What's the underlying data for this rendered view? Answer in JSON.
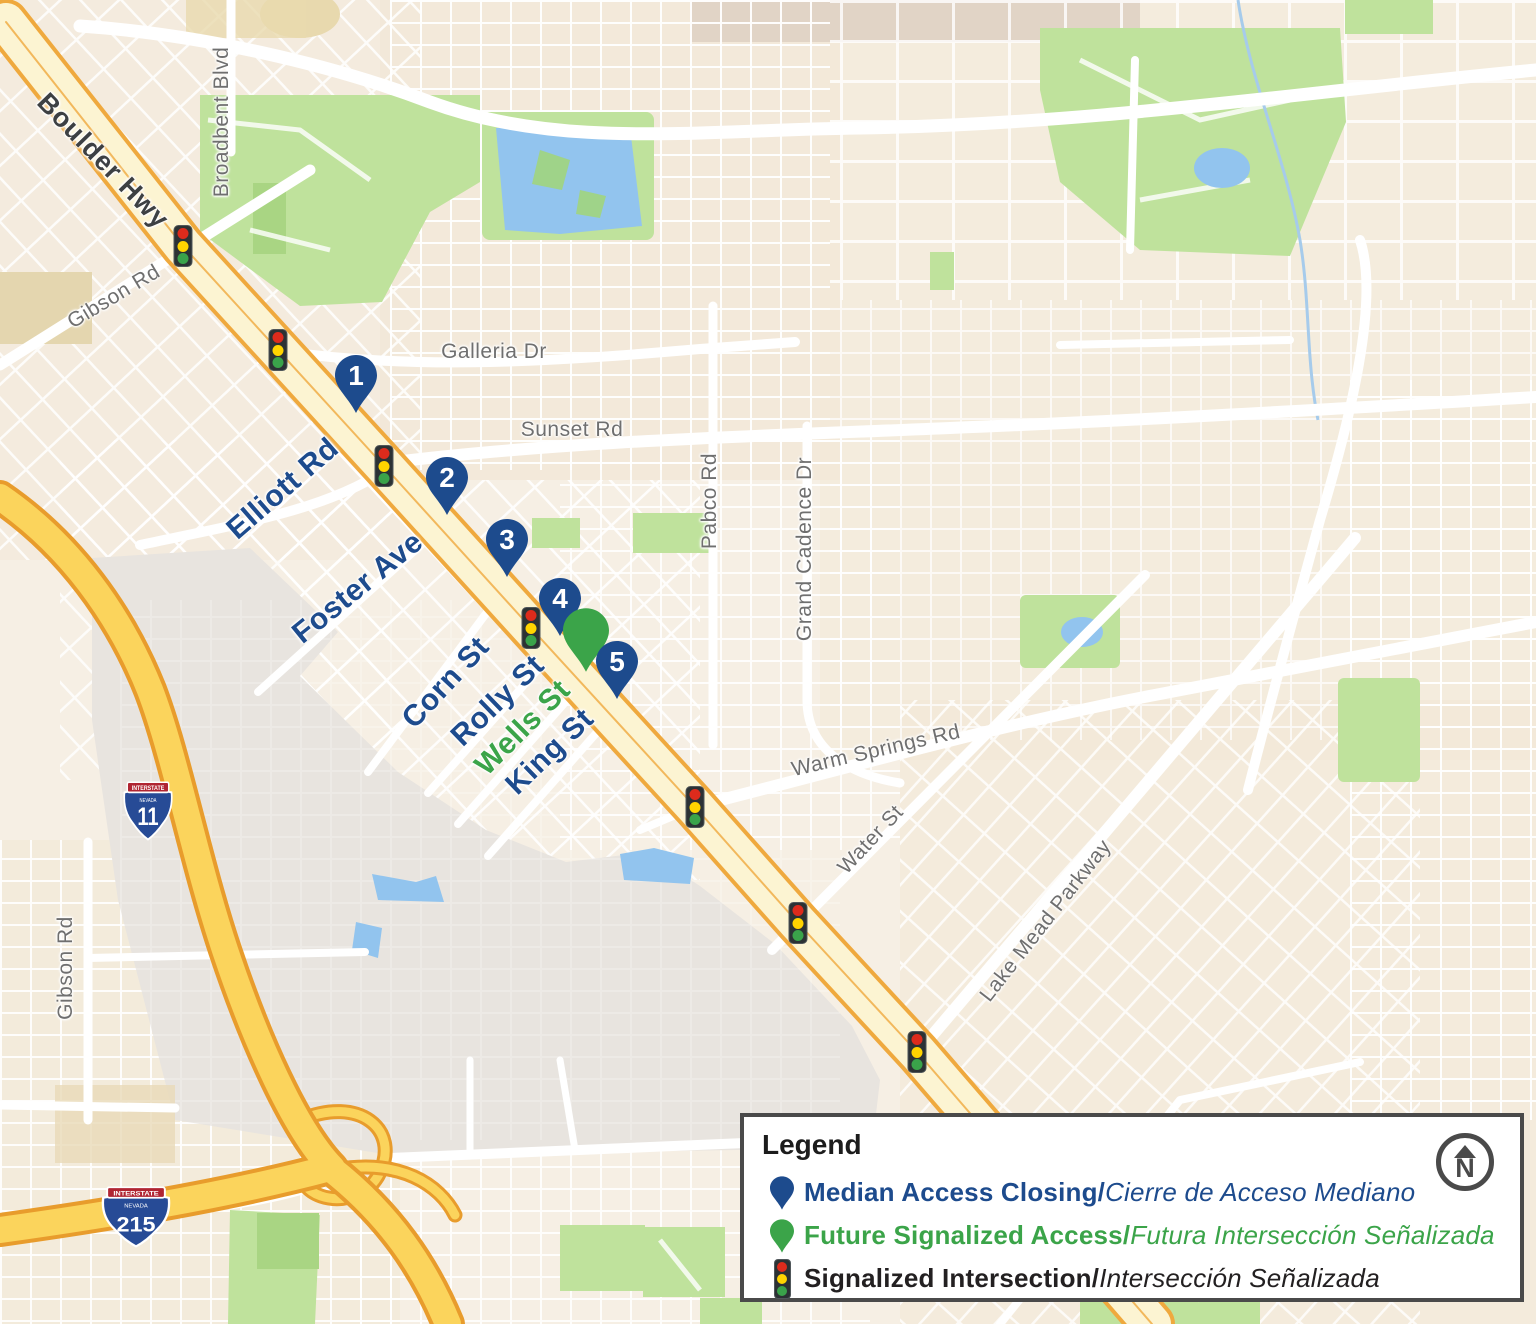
{
  "title": "Boulder Highway median access closing map",
  "colors": {
    "navy": "#1d4b8d",
    "green": "#3ba449",
    "boulder_hwy_fill": "#fcf4d2",
    "boulder_hwy_casing": "#efa93e",
    "freeway_fill": "#fbd45c",
    "freeway_casing": "#e89c2c",
    "park_green": "#bfe29c",
    "water_blue": "#92c4ee",
    "industrial_gray": "#e8e4df",
    "legend_border": "#4a4a4a",
    "traffic_red": "#dd2b1c",
    "traffic_yellow": "#ffd400",
    "traffic_green": "#3aa34a"
  },
  "map": {
    "street_labels": [
      {
        "text": "Boulder Hwy",
        "x": 103,
        "y": 161,
        "rot": 46,
        "style": "hwy"
      },
      {
        "text": "Broadbent Blvd",
        "x": 222,
        "y": 122,
        "rot": -90,
        "style": "gray"
      },
      {
        "text": "Gibson Rd",
        "x": 114,
        "y": 297,
        "rot": -31,
        "style": "gray"
      },
      {
        "text": "Galleria Dr",
        "x": 494,
        "y": 352,
        "rot": 0,
        "style": "gray"
      },
      {
        "text": "Sunset Rd",
        "x": 572,
        "y": 430,
        "rot": 0,
        "style": "gray"
      },
      {
        "text": "Pabco Rd",
        "x": 710,
        "y": 501,
        "rot": -90,
        "style": "gray"
      },
      {
        "text": "Grand Cadence Dr",
        "x": 805,
        "y": 549,
        "rot": -90,
        "style": "gray"
      },
      {
        "text": "Warm Springs Rd",
        "x": 876,
        "y": 751,
        "rot": -13,
        "style": "gray"
      },
      {
        "text": "Water St",
        "x": 871,
        "y": 840,
        "rot": -47,
        "style": "gray"
      },
      {
        "text": "Lake Mead Parkway",
        "x": 1046,
        "y": 921,
        "rot": -52,
        "style": "gray"
      },
      {
        "text": "Gibson Rd",
        "x": 66,
        "y": 968,
        "rot": -90,
        "style": "gray"
      },
      {
        "text": "Elliott Rd",
        "x": 283,
        "y": 489,
        "rot": -41,
        "style": "navy"
      },
      {
        "text": "Foster Ave",
        "x": 358,
        "y": 588,
        "rot": -39,
        "style": "navy"
      },
      {
        "text": "Corn St",
        "x": 446,
        "y": 683,
        "rot": -47,
        "style": "navy"
      },
      {
        "text": "Rolly St",
        "x": 498,
        "y": 701,
        "rot": -44,
        "style": "navy"
      },
      {
        "text": "Wells St",
        "x": 523,
        "y": 728,
        "rot": -45,
        "style": "green"
      },
      {
        "text": "King St",
        "x": 550,
        "y": 752,
        "rot": -44,
        "style": "navy"
      }
    ],
    "markers": [
      {
        "label": "1",
        "type": "median-access-closing",
        "x": 356,
        "y": 418
      },
      {
        "label": "2",
        "type": "median-access-closing",
        "x": 447,
        "y": 520
      },
      {
        "label": "3",
        "type": "median-access-closing",
        "x": 507,
        "y": 582
      },
      {
        "label": "4",
        "type": "median-access-closing",
        "x": 560,
        "y": 641
      },
      {
        "label": "",
        "type": "future-signalized-access",
        "x": 586,
        "y": 677
      },
      {
        "label": "5",
        "type": "median-access-closing",
        "x": 617,
        "y": 704
      }
    ],
    "traffic_lights": [
      {
        "x": 183,
        "y": 246
      },
      {
        "x": 278,
        "y": 350
      },
      {
        "x": 384,
        "y": 466
      },
      {
        "x": 531,
        "y": 628
      },
      {
        "x": 695,
        "y": 807
      },
      {
        "x": 798,
        "y": 923
      },
      {
        "x": 917,
        "y": 1052
      }
    ],
    "shields": [
      {
        "system": "INTERSTATE",
        "state": "NEVADA",
        "route": "11",
        "x": 148,
        "y": 814,
        "w": 56,
        "h": 60
      },
      {
        "system": "INTERSTATE",
        "state": "NEVADA",
        "route": "215",
        "x": 136,
        "y": 1220,
        "w": 78,
        "h": 62
      }
    ]
  },
  "legend": {
    "title": "Legend",
    "items": [
      {
        "icon": "pin-navy",
        "bold": "Median Access Closing/",
        "italic": "Cierre de Acceso Mediano",
        "color": "#1d4b8d"
      },
      {
        "icon": "pin-green",
        "bold": "Future Signalized Access/",
        "italic": "Futura Intersección Señalizada",
        "color": "#3ba449"
      },
      {
        "icon": "traffic-light",
        "bold": "Signalized Intersection/",
        "italic": "Intersección Señalizada",
        "color": "#232021"
      }
    ],
    "north_label": "N"
  }
}
